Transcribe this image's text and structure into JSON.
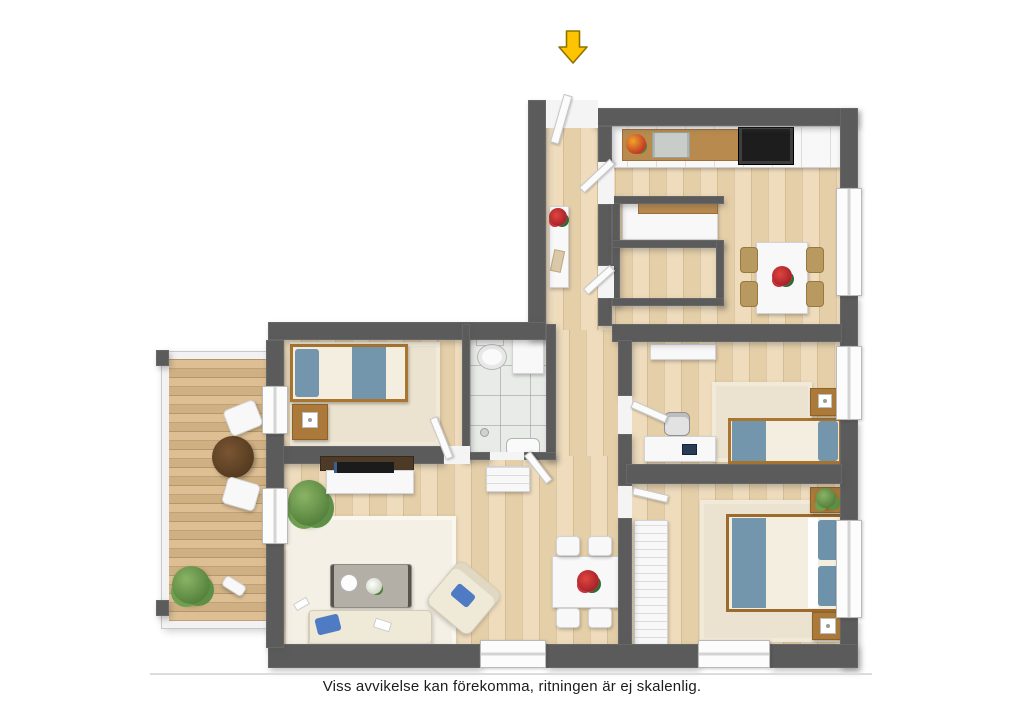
{
  "disclaimer": "Viss avvikelse kan förekomma, ritningen är ej skalenlig.",
  "entry_arrow": {
    "icon": "arrow-down-icon",
    "fill": "#FFC400",
    "outline": "#8F7300"
  },
  "palette": {
    "wall": "#5B5B5B",
    "wood_floor": "#EBD9B8",
    "balcony_deck": "#D8BC8F",
    "bathroom_tile": "#E9EBE8",
    "bedding_blue": "#7396AD",
    "pillow_accent_blue": "#4F7BC4",
    "furniture_wood": "#AB7A3A",
    "white_furniture": "#F8F8F8",
    "flower_red": "#CF2B35",
    "plant_green": "#5D8F46"
  },
  "rooms": [
    {
      "name": "entry-hall",
      "furniture": [
        "console-table",
        "red-flowers"
      ]
    },
    {
      "name": "kitchen",
      "furniture": [
        "counter",
        "double-sink",
        "cooktop",
        "fruit-bowl",
        "pantry-cabinet",
        "dining-table",
        "four-chairs",
        "red-flowers"
      ]
    },
    {
      "name": "bathroom",
      "furniture": [
        "toilet",
        "washer-cabinet",
        "sink",
        "floor-drain"
      ]
    },
    {
      "name": "bedroom-top-left",
      "furniture": [
        "single-bed",
        "nightstand",
        "lamp",
        "rug"
      ]
    },
    {
      "name": "bedroom-middle-right",
      "furniture": [
        "single-bed",
        "desk",
        "office-chair",
        "laptop",
        "nightstand",
        "lamp",
        "dresser",
        "rug"
      ]
    },
    {
      "name": "bedroom-bottom-right",
      "furniture": [
        "double-bed",
        "blue-pillows",
        "nightstand-with-plant",
        "nightstand-with-lamp",
        "wardrobe",
        "rug"
      ]
    },
    {
      "name": "living-room",
      "furniture": [
        "sofa",
        "blue-pillow",
        "coffee-table",
        "teapot",
        "armchair",
        "tv-bench",
        "tv",
        "plant",
        "rug"
      ]
    },
    {
      "name": "dining-area",
      "furniture": [
        "dining-table",
        "four-chairs",
        "red-flowers",
        "tall-cabinet"
      ]
    },
    {
      "name": "balcony",
      "furniture": [
        "round-table",
        "two-chairs",
        "bush-plant",
        "watering-can"
      ]
    }
  ]
}
